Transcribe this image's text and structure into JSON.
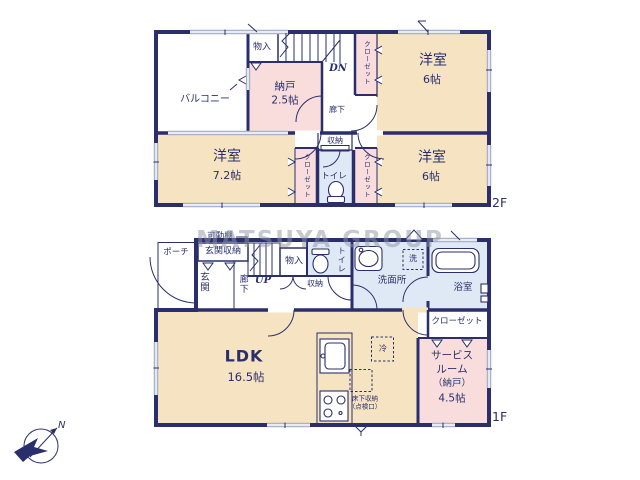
{
  "watermark": "MATSUYA GROUP",
  "compass": {
    "north": "N"
  },
  "f2": {
    "floor_label": "2F",
    "balcony": "バルコニー",
    "monoire": "物入",
    "stairs_dn": "DN",
    "closet": "クローゼット",
    "nando_name": "納戸",
    "nando_size": "2.5帖",
    "rouka": "廊下",
    "room_tr_name": "洋室",
    "room_tr_size": "6帖",
    "room_left_name": "洋室",
    "room_left_size": "7.2帖",
    "room_br_name": "洋室",
    "room_br_size": "6帖",
    "shuunou": "収納",
    "toilet": "トイレ"
  },
  "f1": {
    "floor_label": "1F",
    "porch": "ポーチ",
    "kadoudana": "可動棚",
    "genkan_shuunou": "玄関収納",
    "genkan": "玄関",
    "rouka": "廊下",
    "stairs_up": "UP",
    "monoire": "物入",
    "shuunou": "収納",
    "toilet": "トイレ",
    "senmenjo": "洗面所",
    "laundry": "洗",
    "bath": "浴室",
    "ldk_name": "LDK",
    "ldk_size": "16.5帖",
    "fridge": "冷",
    "yukashita_line1": "床下収納",
    "yukashita_line2": "（点検口）",
    "closet": "クローゼット",
    "service_line1": "サービス",
    "service_line2": "ルーム",
    "service_line3": "（納戸）",
    "service_line4": "4.5帖"
  },
  "colors": {
    "wall_navy": "#2A2F6B",
    "room_cream": "#F6E3C1",
    "room_pink": "#F8DDDC",
    "room_blue": "#DFE9F5",
    "window_gray": "#A9B1CB",
    "watermark_gray": "#8E94A6"
  }
}
